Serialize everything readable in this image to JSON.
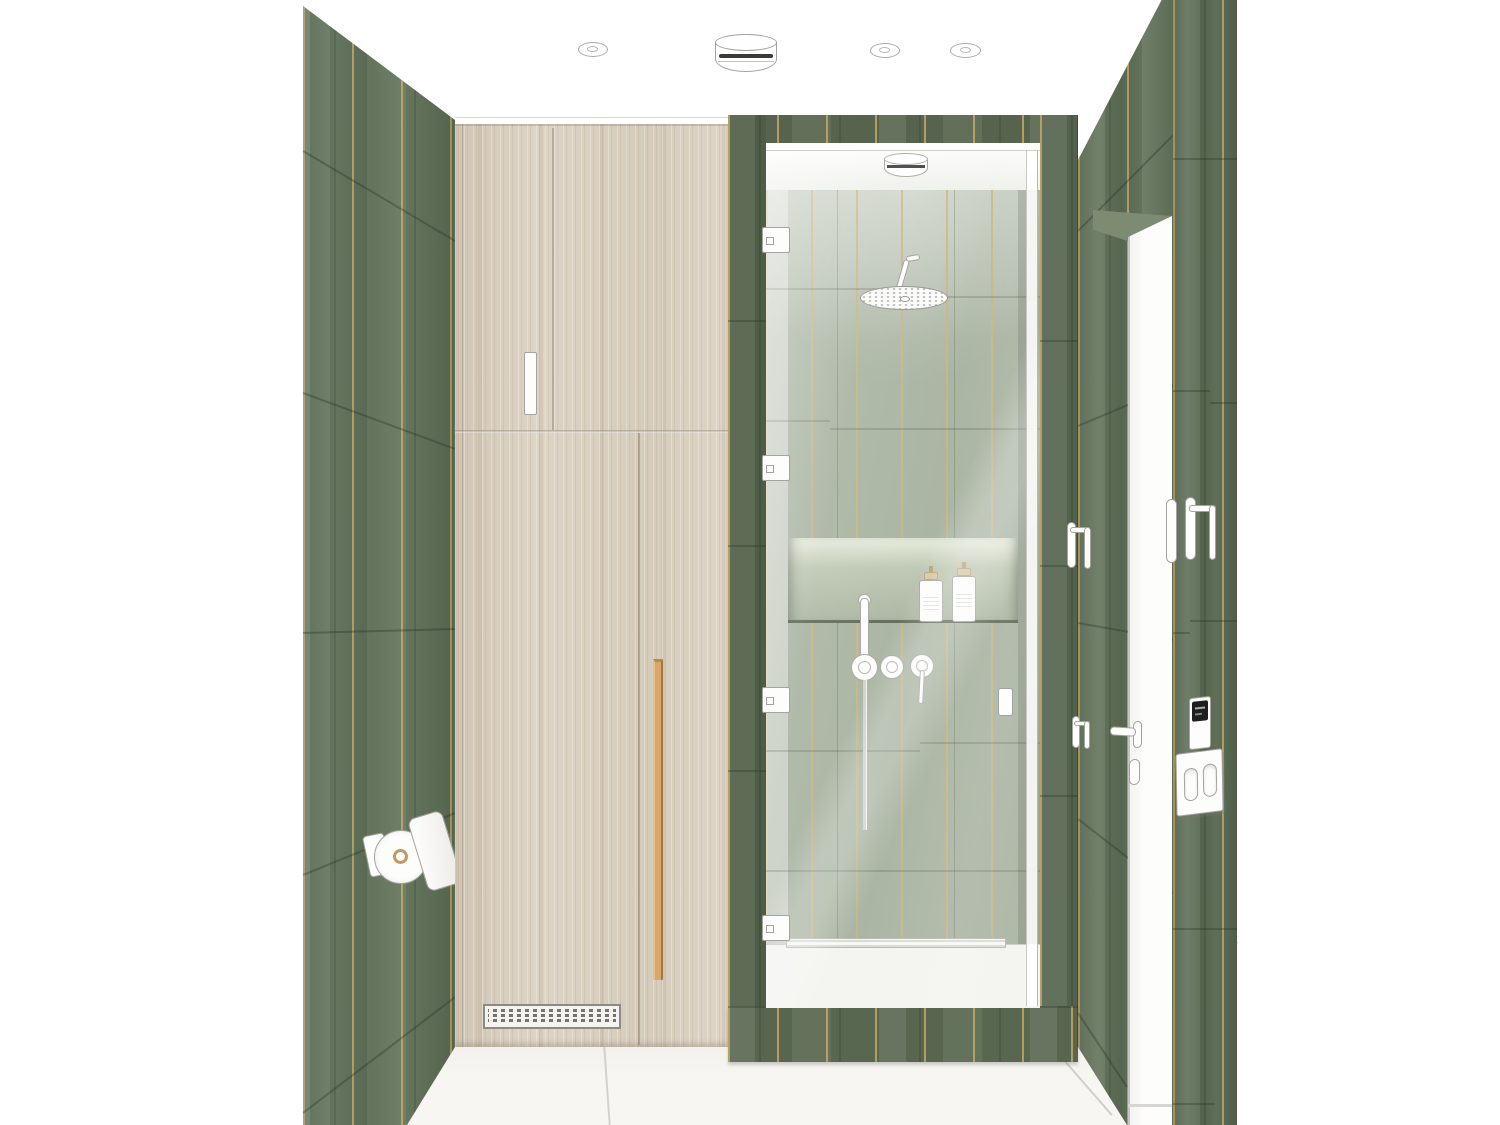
{
  "scene": {
    "title": "Bathroom interior rendering",
    "view": "one-point perspective toward shower wall",
    "visible_text": ""
  },
  "colors": {
    "c-wall": "#66785e",
    "c-wall-dark": "#596а51",
    "c-frame": "#5d6b54",
    "c-interior": "#a6b19e",
    "c-wood": "#dbd1c1",
    "c-pull": "#d9a66b",
    "c-floor": "#f6f5f1",
    "c-fixture": "#fdfdfc",
    "c-outline": "#a3a39f",
    "c-screen": "#1e201d",
    "c-grout": "#c8a865"
  },
  "materials": {
    "walls": "green glazed vertical tiles with brass inlay strips",
    "cabinet": "light oak veneer",
    "floor": "off-white stone tile"
  },
  "fixtures": {
    "ceiling_drum_light": {
      "label": "Ceiling drum light"
    },
    "ceiling_spotlight": {
      "label": "Recessed ceiling spotlight"
    },
    "shower_ceiling_light": {
      "label": "Shower ceiling drum light"
    },
    "rain_shower_head": {
      "label": "Round rain shower head"
    },
    "shower_arm": {
      "label": "Shower arm"
    },
    "hand_shower": {
      "label": "Hand shower on bracket"
    },
    "shower_valve": {
      "label": "Shower mixer valve"
    },
    "valve_lever": {
      "label": "Mixer lever"
    },
    "shower_hose": {
      "label": "Hand shower hose"
    },
    "shower_niche": {
      "label": "Lit recessed niche"
    },
    "bottle": {
      "label": "Toiletry pump bottle"
    },
    "linear_drain": {
      "label": "Linear shower drain"
    },
    "glass_door": {
      "label": "Frameless glass shower door"
    },
    "door_hinge": {
      "label": "Glass door hinge"
    },
    "glass_door_knob": {
      "label": "Glass door knob"
    },
    "cabinet": {
      "label": "Tall wood storage cabinet"
    },
    "cabinet_handle": {
      "label": "Cabinet handle"
    },
    "cabinet_pull": {
      "label": "Vertical wood door pull"
    },
    "vent_grille": {
      "label": "Ventilation grille"
    },
    "toilet_paper_holder": {
      "label": "Covered toilet paper holder"
    },
    "towel_hook": {
      "label": "Towel hook"
    },
    "entry_door": {
      "label": "White entry door"
    },
    "door_lever": {
      "label": "Door lever handle"
    },
    "door_lock": {
      "label": "Door lock plate"
    },
    "keypad": {
      "label": "Wall keypad / thermostat"
    },
    "light_switch": {
      "label": "Double rocker light switch"
    }
  }
}
